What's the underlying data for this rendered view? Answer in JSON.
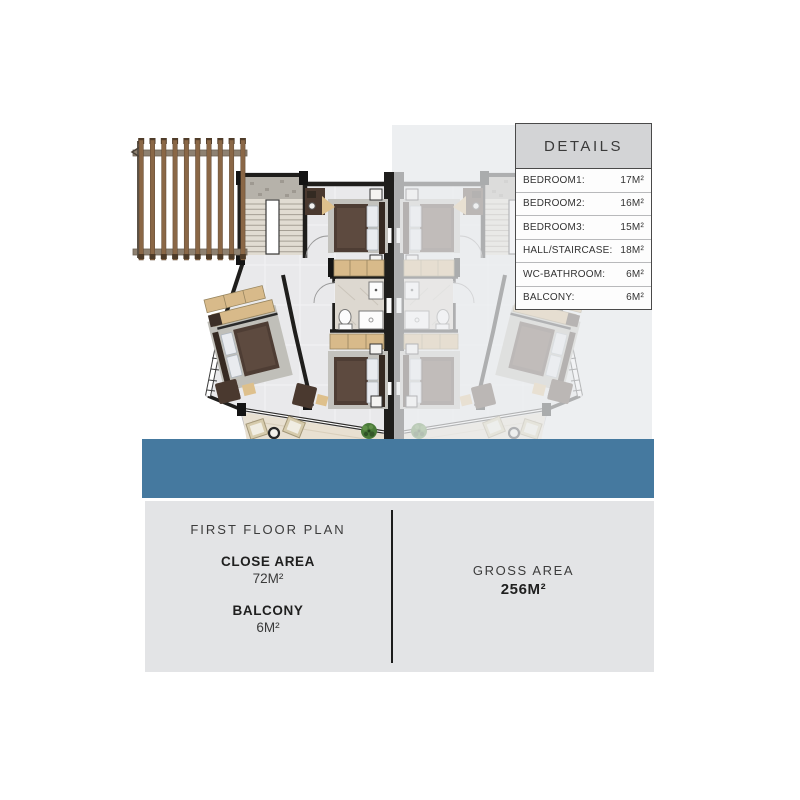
{
  "details_table": {
    "title": "DETAILS",
    "rows": [
      {
        "label": "BEDROOM1:",
        "value": "17M²"
      },
      {
        "label": "BEDROOM2:",
        "value": "16M²"
      },
      {
        "label": "BEDROOM3:",
        "value": "15M²"
      },
      {
        "label": "HALL/STAIRCASE:",
        "value": "18M²"
      },
      {
        "label": "WC-BATHROOM:",
        "value": "6M²"
      },
      {
        "label": "BALCONY:",
        "value": "6M²"
      }
    ]
  },
  "footer": {
    "plan_title": "FIRST FLOOR PLAN",
    "close_area_label": "CLOSE AREA",
    "close_area_value": "72M²",
    "balcony_label": "BALCONY",
    "balcony_value": "6M²",
    "gross_area_label": "GROSS AREA",
    "gross_area_value": "256M²"
  },
  "colors": {
    "accent_band": "#45799f",
    "footer_panel": "#e3e4e6",
    "table_header": "#d3d4d6",
    "wall": "#1f1e1c",
    "wood_pergola": "#8a6746",
    "closet_tan": "#d8ba8a"
  },
  "graphic": {
    "description": "First floor architectural plan: main unit with three bedrooms, hall/staircase, WC-bathroom and balcony; faded mirrored adjacent unit on the right; wooden pergola on the left."
  }
}
